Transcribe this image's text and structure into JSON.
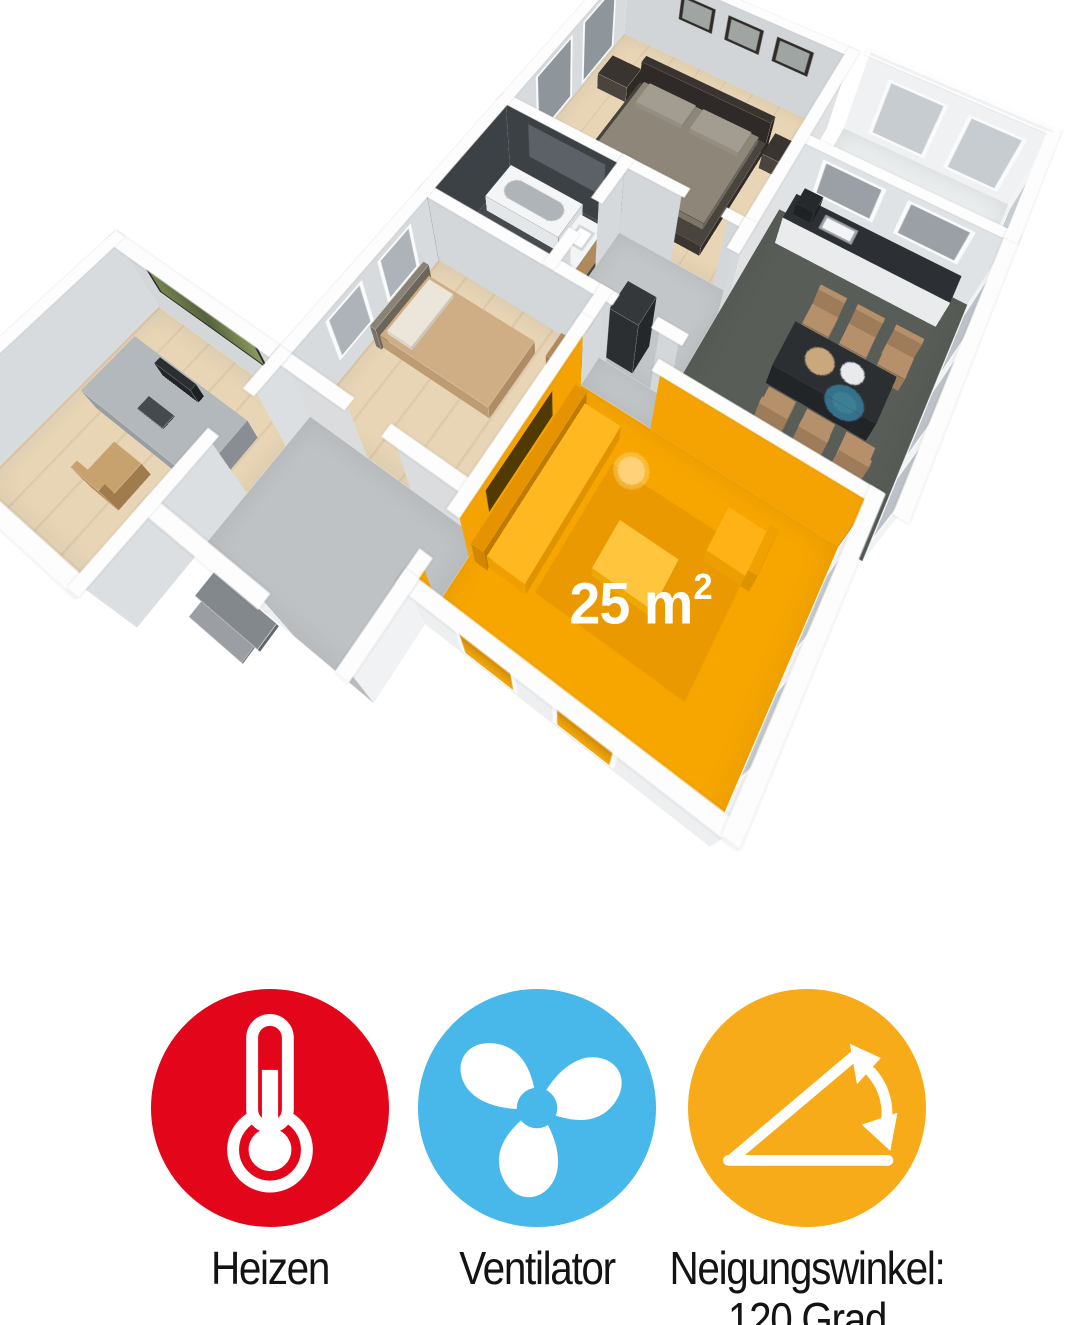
{
  "floorplan": {
    "area_value": "25 m",
    "area_sup": "2",
    "highlight_color": "#F7A600"
  },
  "features": [
    {
      "icon": "thermometer-icon",
      "circle_color": "#E3061A",
      "label": "Heizen"
    },
    {
      "icon": "fan-icon",
      "circle_color": "#47B8E9",
      "label": "Ventilator"
    },
    {
      "icon": "tilt-angle-icon",
      "circle_color": "#F8AB18",
      "label": "Neigungswinkel:",
      "label_line2": "120 Grad"
    }
  ]
}
